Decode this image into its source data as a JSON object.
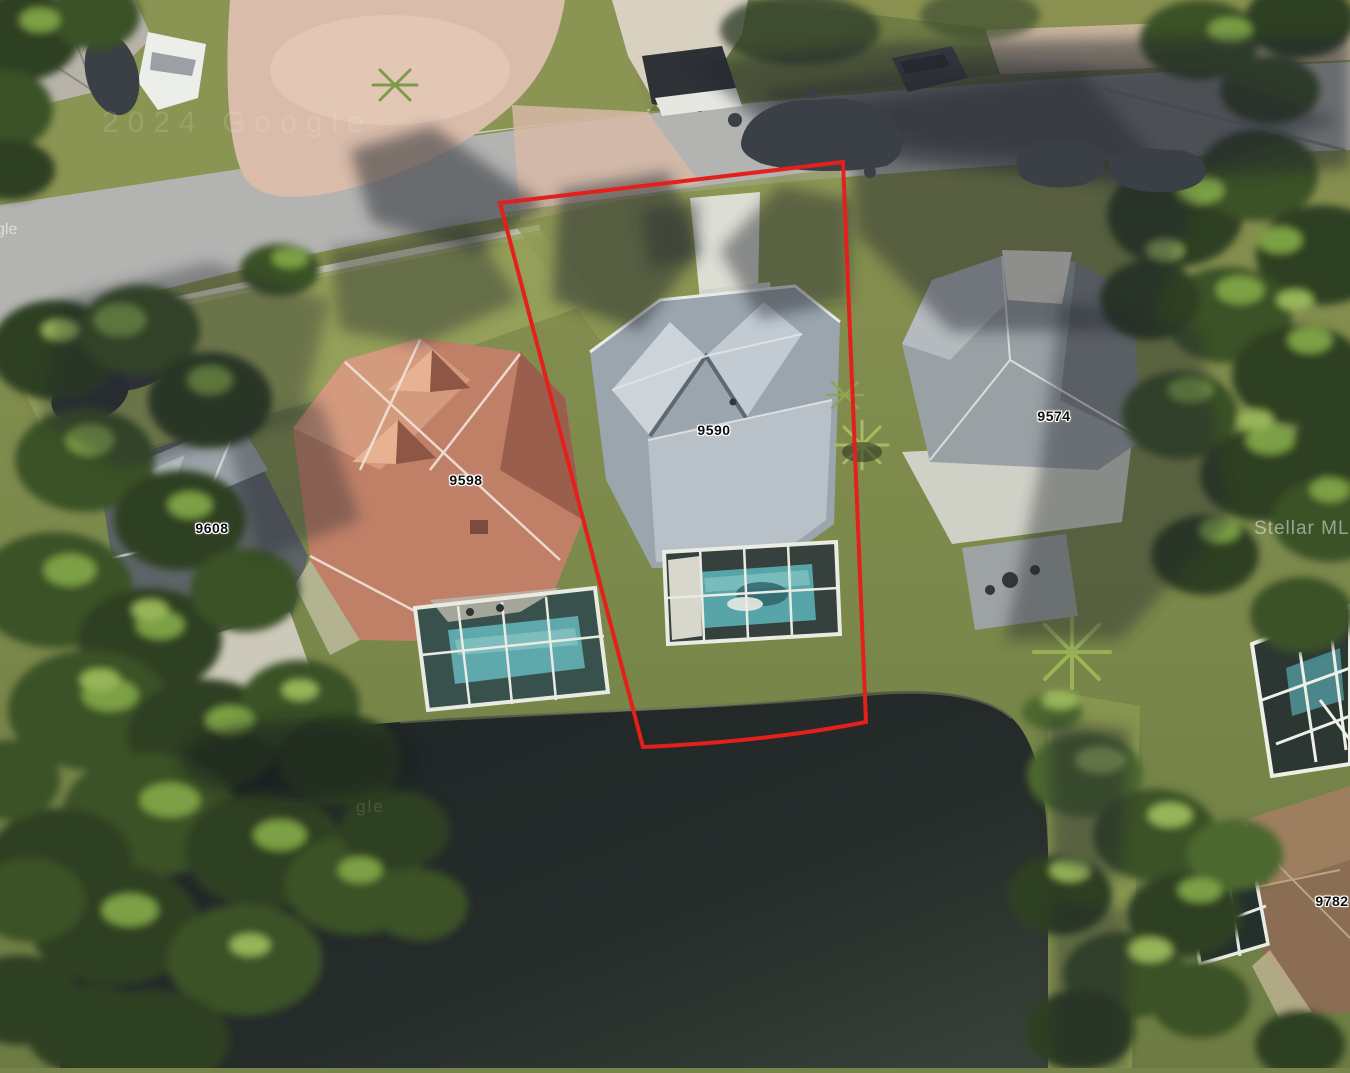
{
  "scene": {
    "type": "satellite-aerial-photo",
    "outlined_parcel": "9590"
  },
  "parcel_labels": [
    {
      "text": "9608"
    },
    {
      "text": "9598"
    },
    {
      "text": "9590"
    },
    {
      "text": "9574"
    },
    {
      "text": "9782"
    }
  ],
  "watermarks": {
    "copyright_fragment": "2024 Google",
    "left_edge_fragment": "gle",
    "lake_fragment": "gle",
    "mls": "Stellar MLS"
  },
  "colors": {
    "boundary": "#e3201b",
    "label_text": "#0d0d0d",
    "label_halo": "#ffffff",
    "watermark": "#ffffff"
  }
}
